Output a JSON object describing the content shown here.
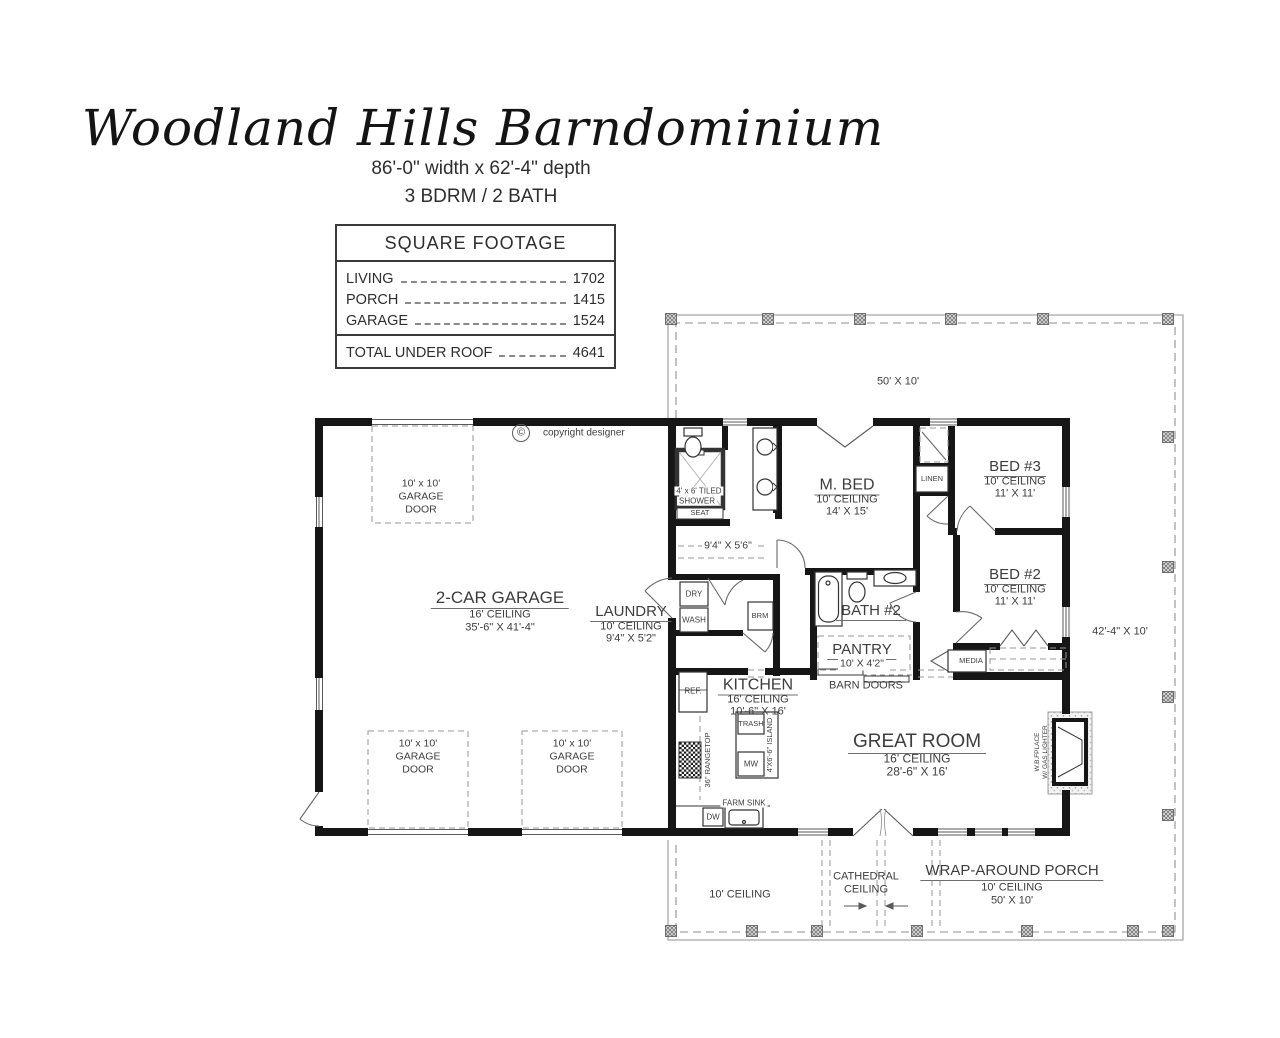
{
  "header": {
    "title": "Woodland Hills Barndominium",
    "dimensions": "86'-0\" width x 62'-4\" depth",
    "beds_baths": "3 BDRM / 2 BATH"
  },
  "square_footage": {
    "header": "SQUARE FOOTAGE",
    "rows": [
      {
        "label": "LIVING",
        "value": "1702"
      },
      {
        "label": "PORCH",
        "value": "1415"
      },
      {
        "label": "GARAGE",
        "value": "1524"
      }
    ],
    "total": {
      "label": "TOTAL UNDER ROOF",
      "value": "4641"
    }
  },
  "copyright": {
    "symbol": "©",
    "text": "copyright designer"
  },
  "rooms": {
    "garage": {
      "name": "2-CAR GARAGE",
      "ceiling": "16' CEILING",
      "dims": "35'-6\" X 41'-4\""
    },
    "laundry": {
      "name": "LAUNDRY",
      "ceiling": "10' CEILING",
      "dims": "9'4\" X 5'2\""
    },
    "master_bed": {
      "name": "M. BED",
      "ceiling": "10' CEILING",
      "dims": "14' X 15'"
    },
    "bed3": {
      "name": "BED #3",
      "ceiling": "10' CEILING",
      "dims": "11' X 11'"
    },
    "bed2": {
      "name": "BED #2",
      "ceiling": "10' CEILING",
      "dims": "11' X 11'"
    },
    "bath2": {
      "name": "BATH #2"
    },
    "pantry": {
      "name": "PANTRY",
      "dims": "10' X 4'2\""
    },
    "kitchen": {
      "name": "KITCHEN",
      "ceiling": "16' CEILING",
      "dims": "10'-6\" X 16'"
    },
    "great_room": {
      "name": "GREAT ROOM",
      "ceiling": "16' CEILING",
      "dims": "28'-6\" X 16'"
    },
    "wrap_porch": {
      "name": "WRAP-AROUND PORCH",
      "ceiling": "10' CEILING",
      "dims": "50' X 10'"
    }
  },
  "labels": {
    "garage_door_l1": "10' x 10'",
    "garage_door_l2": "GARAGE",
    "garage_door_l3": "DOOR",
    "shower_l1": "4' x 6' TILED",
    "shower_l2": "SHOWER",
    "seat": "SEAT",
    "m_closet_dims": "9'4\" X 5'6\"",
    "linen": "LINEN",
    "dry": "DRY",
    "wash": "WASH",
    "brm": "BRM",
    "media": "MEDIA",
    "ref": "REF.",
    "trash": "TRASH",
    "mw": "MW",
    "island": "4'X6'-6\" ISLAND",
    "rangetop": "36\" RANGETOP",
    "farm_sink": "FARM SINK",
    "dw": "DW",
    "fireplace_l1": "W.B.FPLACE",
    "fireplace_l2": "W/ GAS LIGHTER",
    "barn_doors": "BARN DOORS",
    "top_porch_dims": "50' X 10'",
    "right_porch_dims": "42'-4\" X 10'",
    "bottom_porch_ceiling": "10' CEILING",
    "cathedral_l1": "CATHEDRAL",
    "cathedral_l2": "CEILING"
  }
}
